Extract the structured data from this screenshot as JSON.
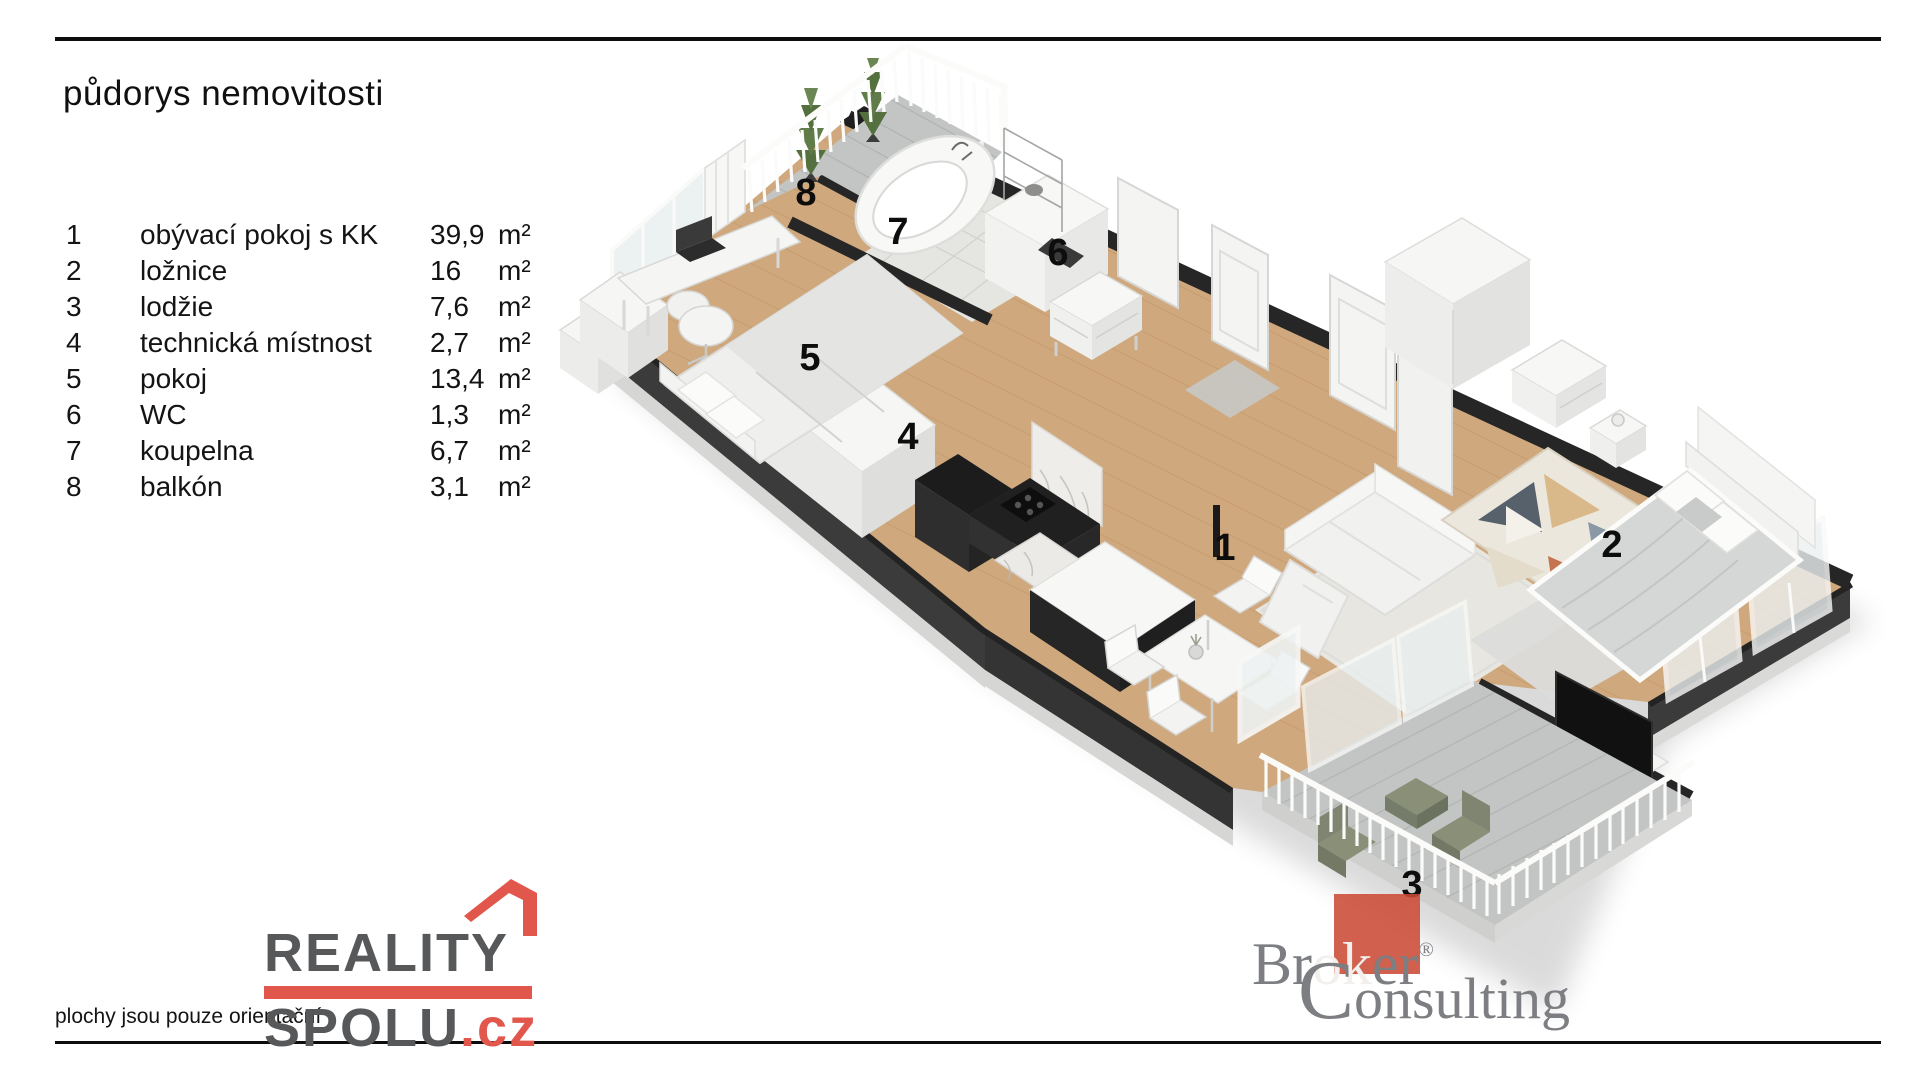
{
  "title": "půdorys nemovitosti",
  "legend": {
    "rows": [
      {
        "num": "1",
        "name": "obývací pokoj s KK",
        "area": "39,9",
        "unit": "m²"
      },
      {
        "num": "2",
        "name": "ložnice",
        "area": "16",
        "unit": "m²"
      },
      {
        "num": "3",
        "name": "lodžie",
        "area": "7,6",
        "unit": "m²"
      },
      {
        "num": "4",
        "name": "technická místnost",
        "area": "2,7",
        "unit": "m²"
      },
      {
        "num": "5",
        "name": "pokoj",
        "area": "13,4",
        "unit": "m²"
      },
      {
        "num": "6",
        "name": "WC",
        "area": "1,3",
        "unit": "m²"
      },
      {
        "num": "7",
        "name": "koupelna",
        "area": "6,7",
        "unit": "m²"
      },
      {
        "num": "8",
        "name": "balkón",
        "area": "3,1",
        "unit": "m²"
      }
    ]
  },
  "plan": {
    "labels": [
      {
        "number": "1"
      },
      {
        "number": "2"
      },
      {
        "number": "3"
      },
      {
        "number": "4"
      },
      {
        "number": "5"
      },
      {
        "number": "6"
      },
      {
        "number": "7"
      },
      {
        "number": "8"
      }
    ]
  },
  "footer": {
    "note": "plochy jsou pouze orientační"
  },
  "logos": {
    "reality_spolu": {
      "line1": "REALITY",
      "line2": "SPOLU",
      "tld": ".cz"
    },
    "broker_consulting": {
      "word1_pre": "Br",
      "word1_mid": "ok",
      "word1_post": "er",
      "registered": "®",
      "word2_initial": "C",
      "word2_rest": "onsulting"
    }
  },
  "colors": {
    "reality_red": "#e2574c",
    "reality_gray": "#57585a",
    "broker_red": "#cb4a35",
    "broker_gray": "#7c7e81",
    "wall_dark": "#262626",
    "floor_wood": "#cfa87d",
    "tile_gray": "#e5e5e2",
    "deck_gray": "#c2c5c3",
    "loggia_furniture_olive": "#8a9077",
    "label_black": "#0d0d0d"
  }
}
